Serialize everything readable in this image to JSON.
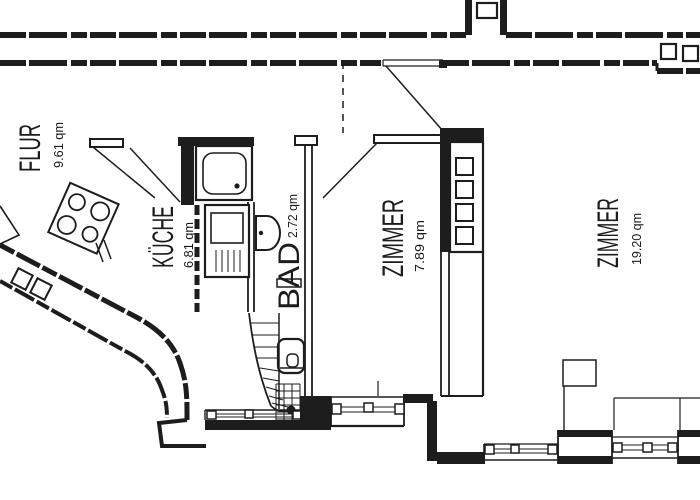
{
  "plan": {
    "colors": {
      "ink": "#1d1d1d",
      "background": "#ffffff"
    },
    "rooms": {
      "flur": {
        "label": "FLUR",
        "area": "9.61 qm"
      },
      "kueche": {
        "label": "KÜCHE",
        "area": "6.81 qm"
      },
      "bad": {
        "label": "BAD",
        "area": "2.72 qm"
      },
      "zimmer_klein": {
        "label": "ZIMMER",
        "area": "7.89 qm"
      },
      "zimmer_gross": {
        "label": "ZIMMER",
        "area": "19.20 qm"
      }
    }
  }
}
